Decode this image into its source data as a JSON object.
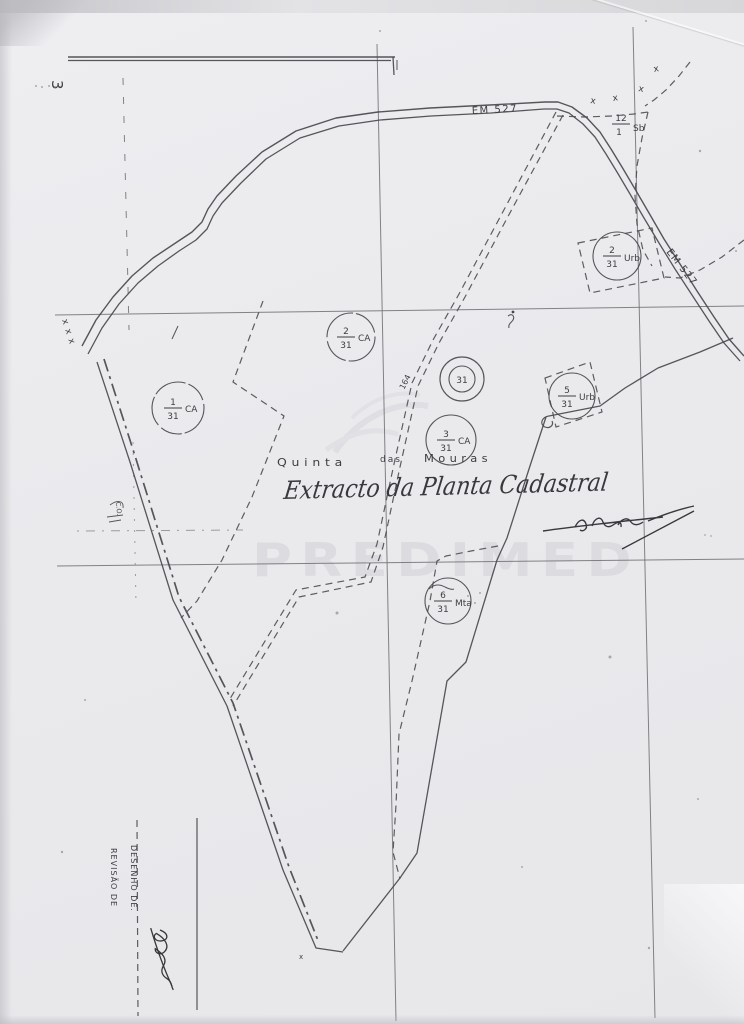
{
  "sheet": {
    "number": "3"
  },
  "map": {
    "road_label": "EM 527",
    "track_label": "164",
    "place": {
      "word1": "Quinta",
      "word2": "das",
      "word3": "Mouras"
    },
    "parcels": {
      "sb": {
        "num": "12",
        "den": "1",
        "suffix": "Sb"
      },
      "urb2": {
        "num": "2",
        "den": "31",
        "suffix": "Urb"
      },
      "urb5": {
        "num": "5",
        "den": "31",
        "suffix": "Urb"
      },
      "ca1": {
        "num": "1",
        "den": "31",
        "suffix": "CA"
      },
      "ca2": {
        "num": "2",
        "den": "31",
        "suffix": "CA"
      },
      "ca3": {
        "num": "3",
        "den": "31",
        "suffix": "CA"
      },
      "mta6": {
        "num": "6",
        "den": "31",
        "suffix": "Mta"
      },
      "center": {
        "label": "31"
      }
    },
    "survey_marks": {
      "x": "x",
      "xxx": "x x x",
      "co": "C.O."
    }
  },
  "annotations": {
    "handwritten_title": "Extracto da Planta Cadastral"
  },
  "titleblock": {
    "desenho": "DESENHO DE.",
    "revisao": "REVISÃO DE"
  },
  "watermark": {
    "text": "PREDIMED"
  }
}
